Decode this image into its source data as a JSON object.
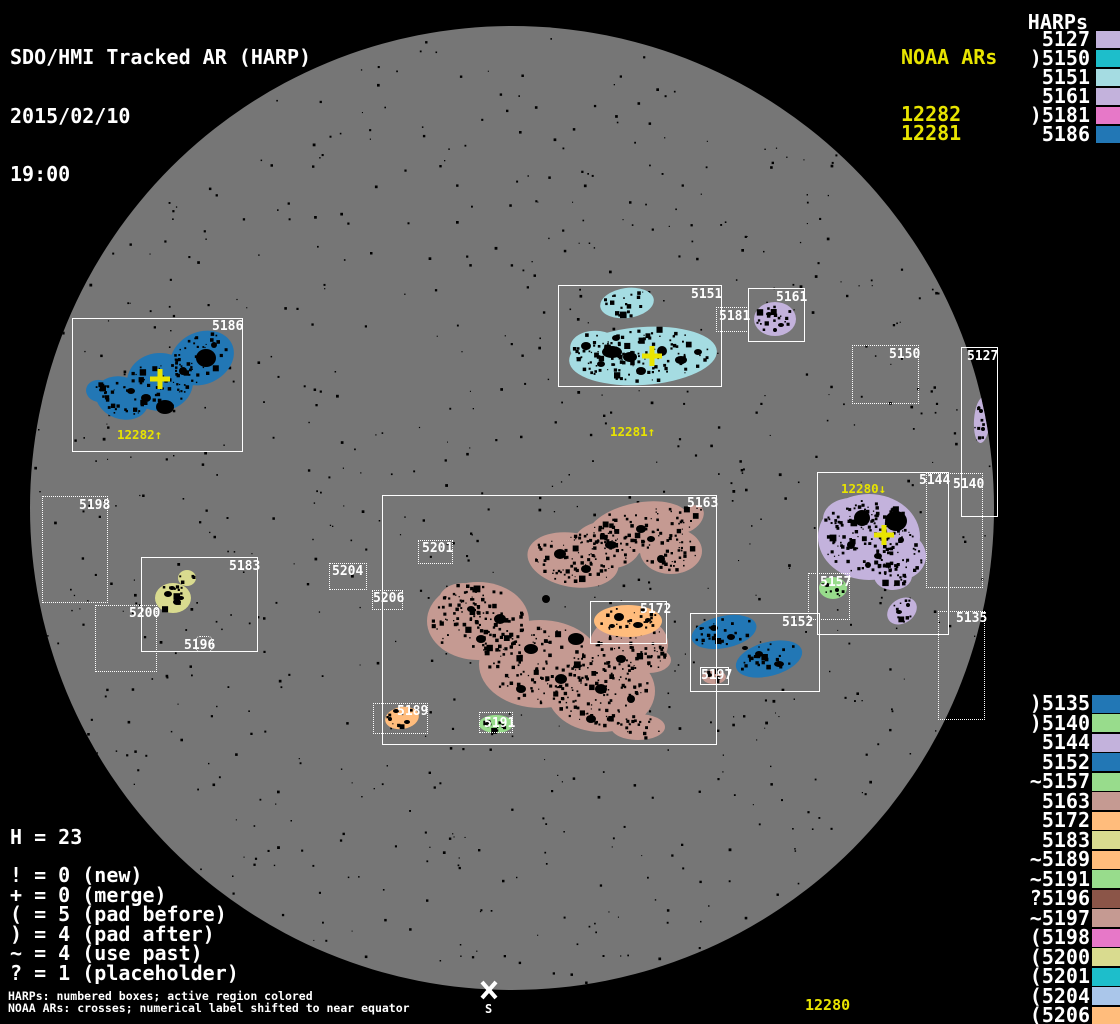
{
  "title": {
    "line1": "SDO/HMI Tracked AR (HARP)",
    "date": "2015/02/10",
    "time": "19:00"
  },
  "colors": {
    "background": "#000000",
    "disk": "#767676",
    "box_line": "#ffffff",
    "label_text": "#ffffff",
    "noaa_yellow": "#e8e400",
    "speckle": "#000000"
  },
  "noaa": {
    "header": "NOAA ARs",
    "items": [
      "12282",
      "12281"
    ]
  },
  "harps_top": {
    "header": "HARPs",
    "items": [
      {
        "text": "5127",
        "color": "#c3b2dc"
      },
      {
        "text": ")5150",
        "color": "#1dbecb"
      },
      {
        "text": "5151",
        "color": "#a5dce2"
      },
      {
        "text": "5161",
        "color": "#c3b2dc"
      },
      {
        "text": ")5181",
        "color": "#e778c8"
      },
      {
        "text": "5186",
        "color": "#2277b5"
      }
    ]
  },
  "harps_bottom": {
    "items": [
      {
        "text": ")5135",
        "color": "#2277b5"
      },
      {
        "text": ")5140",
        "color": "#98dc8c"
      },
      {
        "text": "5144",
        "color": "#c3b2dc"
      },
      {
        "text": "5152",
        "color": "#2277b5"
      },
      {
        "text": "~5157",
        "color": "#98dc8c"
      },
      {
        "text": "5163",
        "color": "#c59a92"
      },
      {
        "text": "5172",
        "color": "#ffbc7c"
      },
      {
        "text": "5183",
        "color": "#d9db8f"
      },
      {
        "text": "~5189",
        "color": "#ffbc7c"
      },
      {
        "text": "~5191",
        "color": "#98dc8c"
      },
      {
        "text": "?5196",
        "color": "#8b5548"
      },
      {
        "text": "~5197",
        "color": "#c59a92"
      },
      {
        "text": "(5198",
        "color": "#e778c8"
      },
      {
        "text": "(5200",
        "color": "#d9db8f"
      },
      {
        "text": "(5201",
        "color": "#1dbecb"
      },
      {
        "text": "(5204",
        "color": "#aac6ea"
      },
      {
        "text": "(5206",
        "color": "#ffbc7c"
      }
    ]
  },
  "legend": {
    "total": "H = 23",
    "rows": [
      "! = 0 (new)",
      "+ = 0 (merge)",
      "( = 5 (pad before)",
      ") = 4 (pad after)",
      "~ = 4 (use past)",
      "? = 1 (placeholder)"
    ]
  },
  "footnotes": {
    "line1": "HARPs: numbered boxes; active region colored",
    "line2": "NOAA ARs: crosses; numerical label shifted to near equator"
  },
  "equator_label": "12280",
  "south": {
    "x": 489,
    "y": 990,
    "label": "S"
  },
  "disk": {
    "cx": 512,
    "cy": 508,
    "r": 482
  },
  "crosses": [
    {
      "id": "12282",
      "x": 160,
      "y": 379,
      "label": "12282↑",
      "lx": 117,
      "ly": 428
    },
    {
      "id": "12281",
      "x": 652,
      "y": 356,
      "label": "12281↑",
      "lx": 610,
      "ly": 425
    },
    {
      "id": "12280",
      "x": 884,
      "y": 535,
      "label": "12280↓",
      "lx": 841,
      "ly": 482
    }
  ],
  "regions": [
    {
      "id": "5186",
      "box": [
        72,
        318,
        171,
        134
      ],
      "border": "solid",
      "label_xy": [
        212,
        320
      ],
      "color": "#2277b5",
      "blobs": [
        [
          122,
          398,
          27,
          21,
          20
        ],
        [
          160,
          382,
          33,
          29,
          0
        ],
        [
          202,
          358,
          33,
          26,
          -25
        ],
        [
          99,
          391,
          13,
          11,
          10
        ]
      ],
      "spots": [
        [
          206,
          358,
          10,
          9
        ],
        [
          165,
          407,
          9,
          7
        ],
        [
          146,
          398,
          5,
          4
        ],
        [
          183,
          371,
          4,
          4
        ],
        [
          131,
          391,
          4,
          3
        ],
        [
          214,
          345,
          3,
          3
        ]
      ]
    },
    {
      "id": "5151",
      "box": [
        558,
        285,
        164,
        102
      ],
      "border": "solid",
      "label_xy": [
        691,
        288
      ],
      "color": "#a5dce2",
      "blobs": [
        [
          627,
          303,
          27,
          15,
          -8
        ],
        [
          643,
          356,
          74,
          29,
          -4
        ],
        [
          598,
          350,
          28,
          19,
          8
        ]
      ],
      "spots": [
        [
          612,
          352,
          10,
          6
        ],
        [
          630,
          357,
          7,
          5
        ],
        [
          586,
          346,
          5,
          4
        ],
        [
          662,
          351,
          5,
          5
        ],
        [
          681,
          360,
          6,
          4
        ],
        [
          641,
          371,
          5,
          4
        ],
        [
          616,
          338,
          4,
          3
        ],
        [
          601,
          364,
          4,
          3
        ],
        [
          698,
          352,
          4,
          3
        ]
      ]
    },
    {
      "id": "5161",
      "box": [
        748,
        288,
        57,
        54
      ],
      "border": "solid",
      "label_xy": [
        776,
        291
      ],
      "color": "#c3b2dc",
      "blobs": [
        [
          775,
          319,
          21,
          17,
          0
        ]
      ],
      "spots": [
        [
          769,
          314,
          3,
          2
        ],
        [
          781,
          325,
          3,
          2
        ],
        [
          775,
          330,
          2,
          2
        ]
      ]
    },
    {
      "id": "5181",
      "box": [
        716,
        307,
        33,
        25
      ],
      "border": "dotted",
      "label_xy": [
        719,
        310
      ],
      "color": null,
      "blobs": [],
      "spots": []
    },
    {
      "id": "5150",
      "box": [
        852,
        345,
        67,
        59
      ],
      "border": "dotted",
      "label_xy": [
        889,
        348
      ],
      "color": null,
      "blobs": [],
      "spots": []
    },
    {
      "id": "5127",
      "box": [
        961,
        347,
        37,
        170
      ],
      "border": "solid",
      "label_xy": [
        967,
        350
      ],
      "color": "#c3b2dc",
      "blobs": [
        [
          982,
          420,
          8,
          23,
          4
        ]
      ],
      "spots": [
        [
          981,
          411,
          2,
          2
        ],
        [
          983,
          429,
          2,
          2
        ]
      ]
    },
    {
      "id": "5144",
      "box": [
        817,
        472,
        132,
        163
      ],
      "border": "solid",
      "label_xy": [
        919,
        474
      ],
      "color": "#c3b2dc",
      "blobs": [
        [
          869,
          537,
          51,
          43,
          0
        ],
        [
          899,
          556,
          27,
          24,
          0
        ],
        [
          851,
          519,
          28,
          21,
          0
        ],
        [
          893,
          576,
          19,
          14,
          0
        ],
        [
          902,
          611,
          16,
          12,
          -35
        ]
      ],
      "spots": [
        [
          862,
          518,
          8,
          8
        ],
        [
          896,
          521,
          11,
          10
        ],
        [
          851,
          545,
          4,
          4
        ],
        [
          878,
          556,
          4,
          3
        ],
        [
          901,
          540,
          3,
          3
        ],
        [
          868,
          565,
          3,
          3
        ],
        [
          899,
          612,
          3,
          2
        ],
        [
          908,
          605,
          2,
          2
        ]
      ]
    },
    {
      "id": "5140",
      "box": [
        926,
        473,
        57,
        115
      ],
      "border": "dotted",
      "label_xy": [
        953,
        478
      ],
      "color": null,
      "blobs": [],
      "spots": []
    },
    {
      "id": "5135",
      "box": [
        938,
        611,
        47,
        109
      ],
      "border": "dotted",
      "label_xy": [
        956,
        612
      ],
      "color": null,
      "blobs": [],
      "spots": []
    },
    {
      "id": "5163",
      "box": [
        382,
        495,
        335,
        250
      ],
      "border": "solid",
      "label_xy": [
        687,
        497
      ],
      "color": "#c59a92",
      "blobs": [
        [
          573,
          560,
          46,
          27,
          10
        ],
        [
          638,
          528,
          52,
          25,
          -12
        ],
        [
          671,
          551,
          31,
          23,
          0
        ],
        [
          607,
          545,
          34,
          24,
          0
        ],
        [
          689,
          519,
          17,
          11,
          -40
        ],
        [
          478,
          621,
          51,
          39,
          0
        ],
        [
          540,
          664,
          61,
          44,
          0
        ],
        [
          601,
          691,
          54,
          41,
          0
        ],
        [
          629,
          644,
          39,
          29,
          0
        ],
        [
          463,
          600,
          24,
          17,
          0
        ],
        [
          649,
          660,
          22,
          13,
          0
        ],
        [
          638,
          727,
          27,
          13,
          0
        ]
      ],
      "spots": [
        [
          560,
          554,
          6,
          5
        ],
        [
          586,
          569,
          5,
          4
        ],
        [
          611,
          545,
          6,
          4
        ],
        [
          641,
          529,
          5,
          4
        ],
        [
          500,
          619,
          6,
          5
        ],
        [
          531,
          649,
          7,
          5
        ],
        [
          561,
          679,
          6,
          5
        ],
        [
          601,
          689,
          6,
          5
        ],
        [
          621,
          659,
          5,
          4
        ],
        [
          481,
          639,
          5,
          4
        ],
        [
          546,
          599,
          4,
          4
        ],
        [
          576,
          639,
          8,
          6
        ],
        [
          611,
          619,
          5,
          5
        ],
        [
          471,
          609,
          4,
          3
        ],
        [
          521,
          689,
          5,
          4
        ],
        [
          651,
          539,
          4,
          3
        ],
        [
          661,
          559,
          4,
          4
        ],
        [
          591,
          719,
          5,
          4
        ],
        [
          631,
          699,
          4,
          4
        ]
      ]
    },
    {
      "id": "5172",
      "box": [
        590,
        601,
        77,
        43
      ],
      "border": "solid",
      "label_xy": [
        640,
        603
      ],
      "color": "#ffbc7c",
      "blobs": [
        [
          628,
          621,
          34,
          16,
          0
        ]
      ],
      "spots": [
        [
          619,
          617,
          5,
          4
        ],
        [
          638,
          625,
          5,
          3
        ],
        [
          612,
          626,
          3,
          2
        ],
        [
          648,
          620,
          3,
          2
        ]
      ]
    },
    {
      "id": "5152",
      "box": [
        690,
        613,
        130,
        79
      ],
      "border": "solid",
      "label_xy": [
        782,
        616
      ],
      "color": "#2277b5",
      "blobs": [
        [
          724,
          632,
          33,
          16,
          -12
        ],
        [
          769,
          659,
          34,
          17,
          -15
        ]
      ],
      "spots": [
        [
          714,
          628,
          4,
          3
        ],
        [
          731,
          637,
          4,
          3
        ],
        [
          759,
          654,
          4,
          3
        ],
        [
          779,
          664,
          5,
          3
        ],
        [
          745,
          648,
          3,
          2
        ]
      ]
    },
    {
      "id": "5157",
      "box": [
        808,
        573,
        42,
        47
      ],
      "border": "dotted",
      "label_xy": [
        820,
        576
      ],
      "color": "#98dc8c",
      "blobs": [
        [
          833,
          588,
          14,
          11,
          0
        ]
      ],
      "spots": [
        [
          827,
          585,
          3,
          2
        ],
        [
          837,
          590,
          2,
          2
        ]
      ]
    },
    {
      "id": "5197",
      "box": [
        700,
        667,
        29,
        18
      ],
      "border": "solid",
      "label_xy": [
        701,
        669
      ],
      "color": "#c59a92",
      "blobs": [
        [
          714,
          677,
          12,
          7,
          0
        ]
      ],
      "spots": [
        [
          709,
          675,
          3,
          2
        ],
        [
          718,
          678,
          3,
          2
        ]
      ]
    },
    {
      "id": "5189",
      "box": [
        373,
        703,
        55,
        31
      ],
      "border": "dotted",
      "label_xy": [
        397,
        705
      ],
      "color": "#ffbc7c",
      "blobs": [
        [
          402,
          718,
          17,
          11,
          -10
        ]
      ],
      "spots": [
        [
          396,
          711,
          3,
          2
        ],
        [
          407,
          722,
          3,
          2
        ],
        [
          390,
          719,
          2,
          2
        ]
      ]
    },
    {
      "id": "5191",
      "box": [
        479,
        712,
        34,
        21
      ],
      "border": "dotted",
      "label_xy": [
        484,
        717
      ],
      "color": "#98dc8c",
      "blobs": [
        [
          496,
          724,
          17,
          9,
          0
        ]
      ],
      "spots": [
        [
          489,
          722,
          2,
          2
        ],
        [
          503,
          726,
          2,
          2
        ]
      ]
    },
    {
      "id": "5183",
      "box": [
        141,
        557,
        117,
        95
      ],
      "border": "solid",
      "label_xy": [
        229,
        560
      ],
      "color": "#d9db8f",
      "blobs": [
        [
          173,
          598,
          18,
          15,
          0
        ],
        [
          187,
          578,
          9,
          8,
          0
        ]
      ],
      "spots": [
        [
          168,
          594,
          4,
          3
        ],
        [
          177,
          602,
          4,
          3
        ],
        [
          172,
          588,
          3,
          2
        ],
        [
          181,
          598,
          3,
          2
        ]
      ]
    },
    {
      "id": "5196",
      "box": [
        195,
        636,
        18,
        16
      ],
      "border": "dotted",
      "rounded": true,
      "label_xy": [
        184,
        639
      ],
      "color": null,
      "blobs": [],
      "spots": []
    },
    {
      "id": "5198",
      "box": [
        42,
        496,
        66,
        107
      ],
      "border": "dotted",
      "label_xy": [
        79,
        499
      ],
      "color": null,
      "blobs": [],
      "spots": []
    },
    {
      "id": "5200",
      "box": [
        95,
        605,
        62,
        67
      ],
      "border": "dotted",
      "label_xy": [
        129,
        607
      ],
      "color": null,
      "blobs": [],
      "spots": []
    },
    {
      "id": "5201",
      "box": [
        418,
        540,
        35,
        24
      ],
      "border": "dotted",
      "label_xy": [
        422,
        542
      ],
      "color": null,
      "blobs": [],
      "spots": []
    },
    {
      "id": "5204",
      "box": [
        329,
        563,
        38,
        27
      ],
      "border": "dotted",
      "label_xy": [
        332,
        565
      ],
      "color": null,
      "blobs": [],
      "spots": []
    },
    {
      "id": "5206",
      "box": [
        372,
        590,
        31,
        20
      ],
      "border": "dotted",
      "label_xy": [
        373,
        592
      ],
      "color": null,
      "blobs": [],
      "spots": []
    }
  ],
  "chart_data": {
    "type": "scatter",
    "title": "SDO/HMI Tracked AR (HARP) 2015/02/10 19:00",
    "notes": "Solar disk map; HARPs shown as numbered boxes with colored active regions; NOAA ARs as yellow crosses",
    "points": [
      {
        "label": "5186",
        "x": 157,
        "y": 385
      },
      {
        "label": "5151",
        "x": 640,
        "y": 336
      },
      {
        "label": "5161",
        "x": 776,
        "y": 315
      },
      {
        "label": "5181",
        "x": 732,
        "y": 319
      },
      {
        "label": "5150",
        "x": 885,
        "y": 374
      },
      {
        "label": "5127",
        "x": 979,
        "y": 432
      },
      {
        "label": "5144",
        "x": 883,
        "y": 553
      },
      {
        "label": "5140",
        "x": 954,
        "y": 530
      },
      {
        "label": "5135",
        "x": 961,
        "y": 665
      },
      {
        "label": "5163",
        "x": 549,
        "y": 620
      },
      {
        "label": "5172",
        "x": 628,
        "y": 622
      },
      {
        "label": "5152",
        "x": 755,
        "y": 652
      },
      {
        "label": "5157",
        "x": 829,
        "y": 596
      },
      {
        "label": "5197",
        "x": 714,
        "y": 676
      },
      {
        "label": "5189",
        "x": 400,
        "y": 718
      },
      {
        "label": "5191",
        "x": 496,
        "y": 722
      },
      {
        "label": "5183",
        "x": 199,
        "y": 604
      },
      {
        "label": "5196",
        "x": 204,
        "y": 644
      },
      {
        "label": "5198",
        "x": 75,
        "y": 549
      },
      {
        "label": "5200",
        "x": 126,
        "y": 638
      },
      {
        "label": "5201",
        "x": 435,
        "y": 552
      },
      {
        "label": "5204",
        "x": 348,
        "y": 576
      },
      {
        "label": "5206",
        "x": 387,
        "y": 600
      },
      {
        "label": "NOAA 12282",
        "x": 160,
        "y": 379
      },
      {
        "label": "NOAA 12281",
        "x": 652,
        "y": 356
      },
      {
        "label": "NOAA 12280",
        "x": 884,
        "y": 535
      }
    ]
  }
}
